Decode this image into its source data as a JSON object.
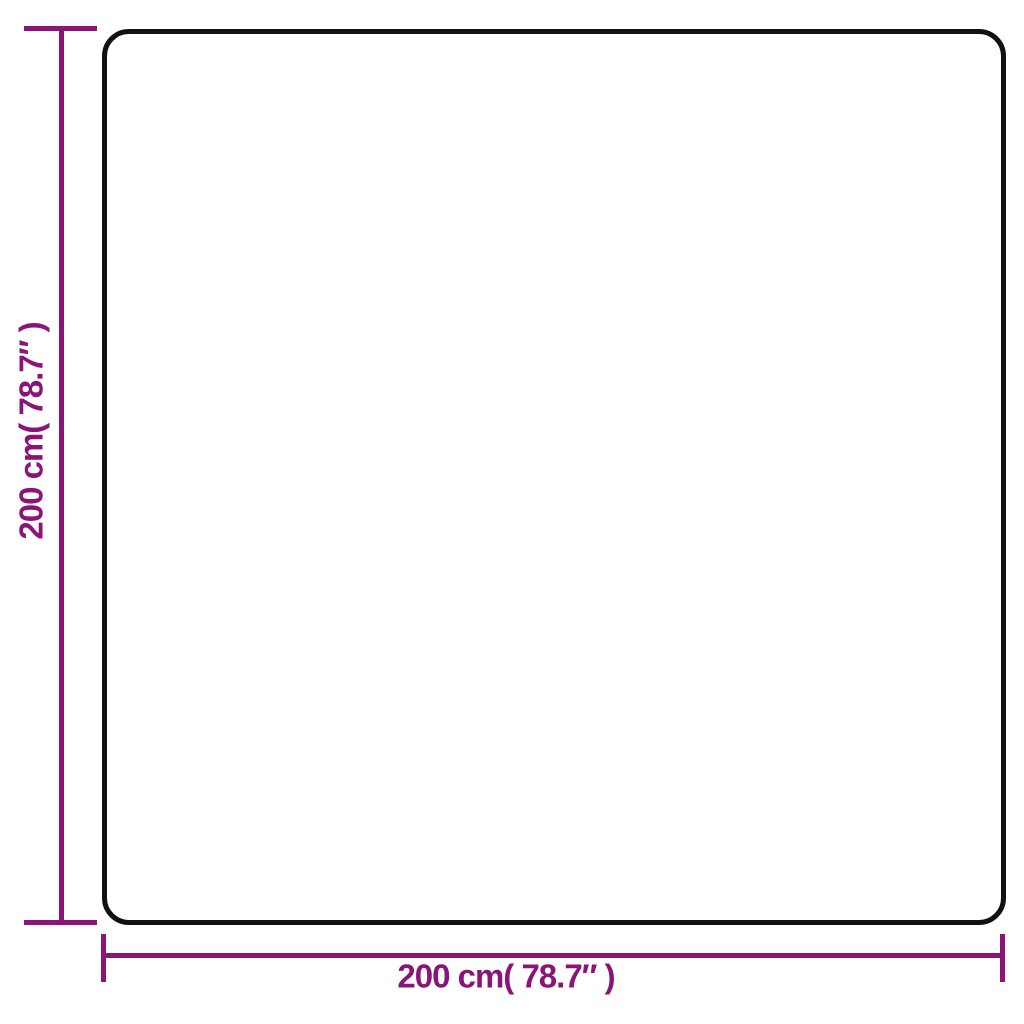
{
  "diagram": {
    "type": "product-dimension-diagram",
    "shape": "square outline with rounded corners",
    "background_color": "#ffffff",
    "outline_color": "#111111",
    "dimension_color": "#8B1478",
    "height_dimension": {
      "value_cm": 200,
      "value_inches": 78.7,
      "label": "200 cm( 78.7″ )"
    },
    "width_dimension": {
      "value_cm": 200,
      "value_inches": 78.7,
      "label": "200 cm( 78.7″ )"
    }
  }
}
